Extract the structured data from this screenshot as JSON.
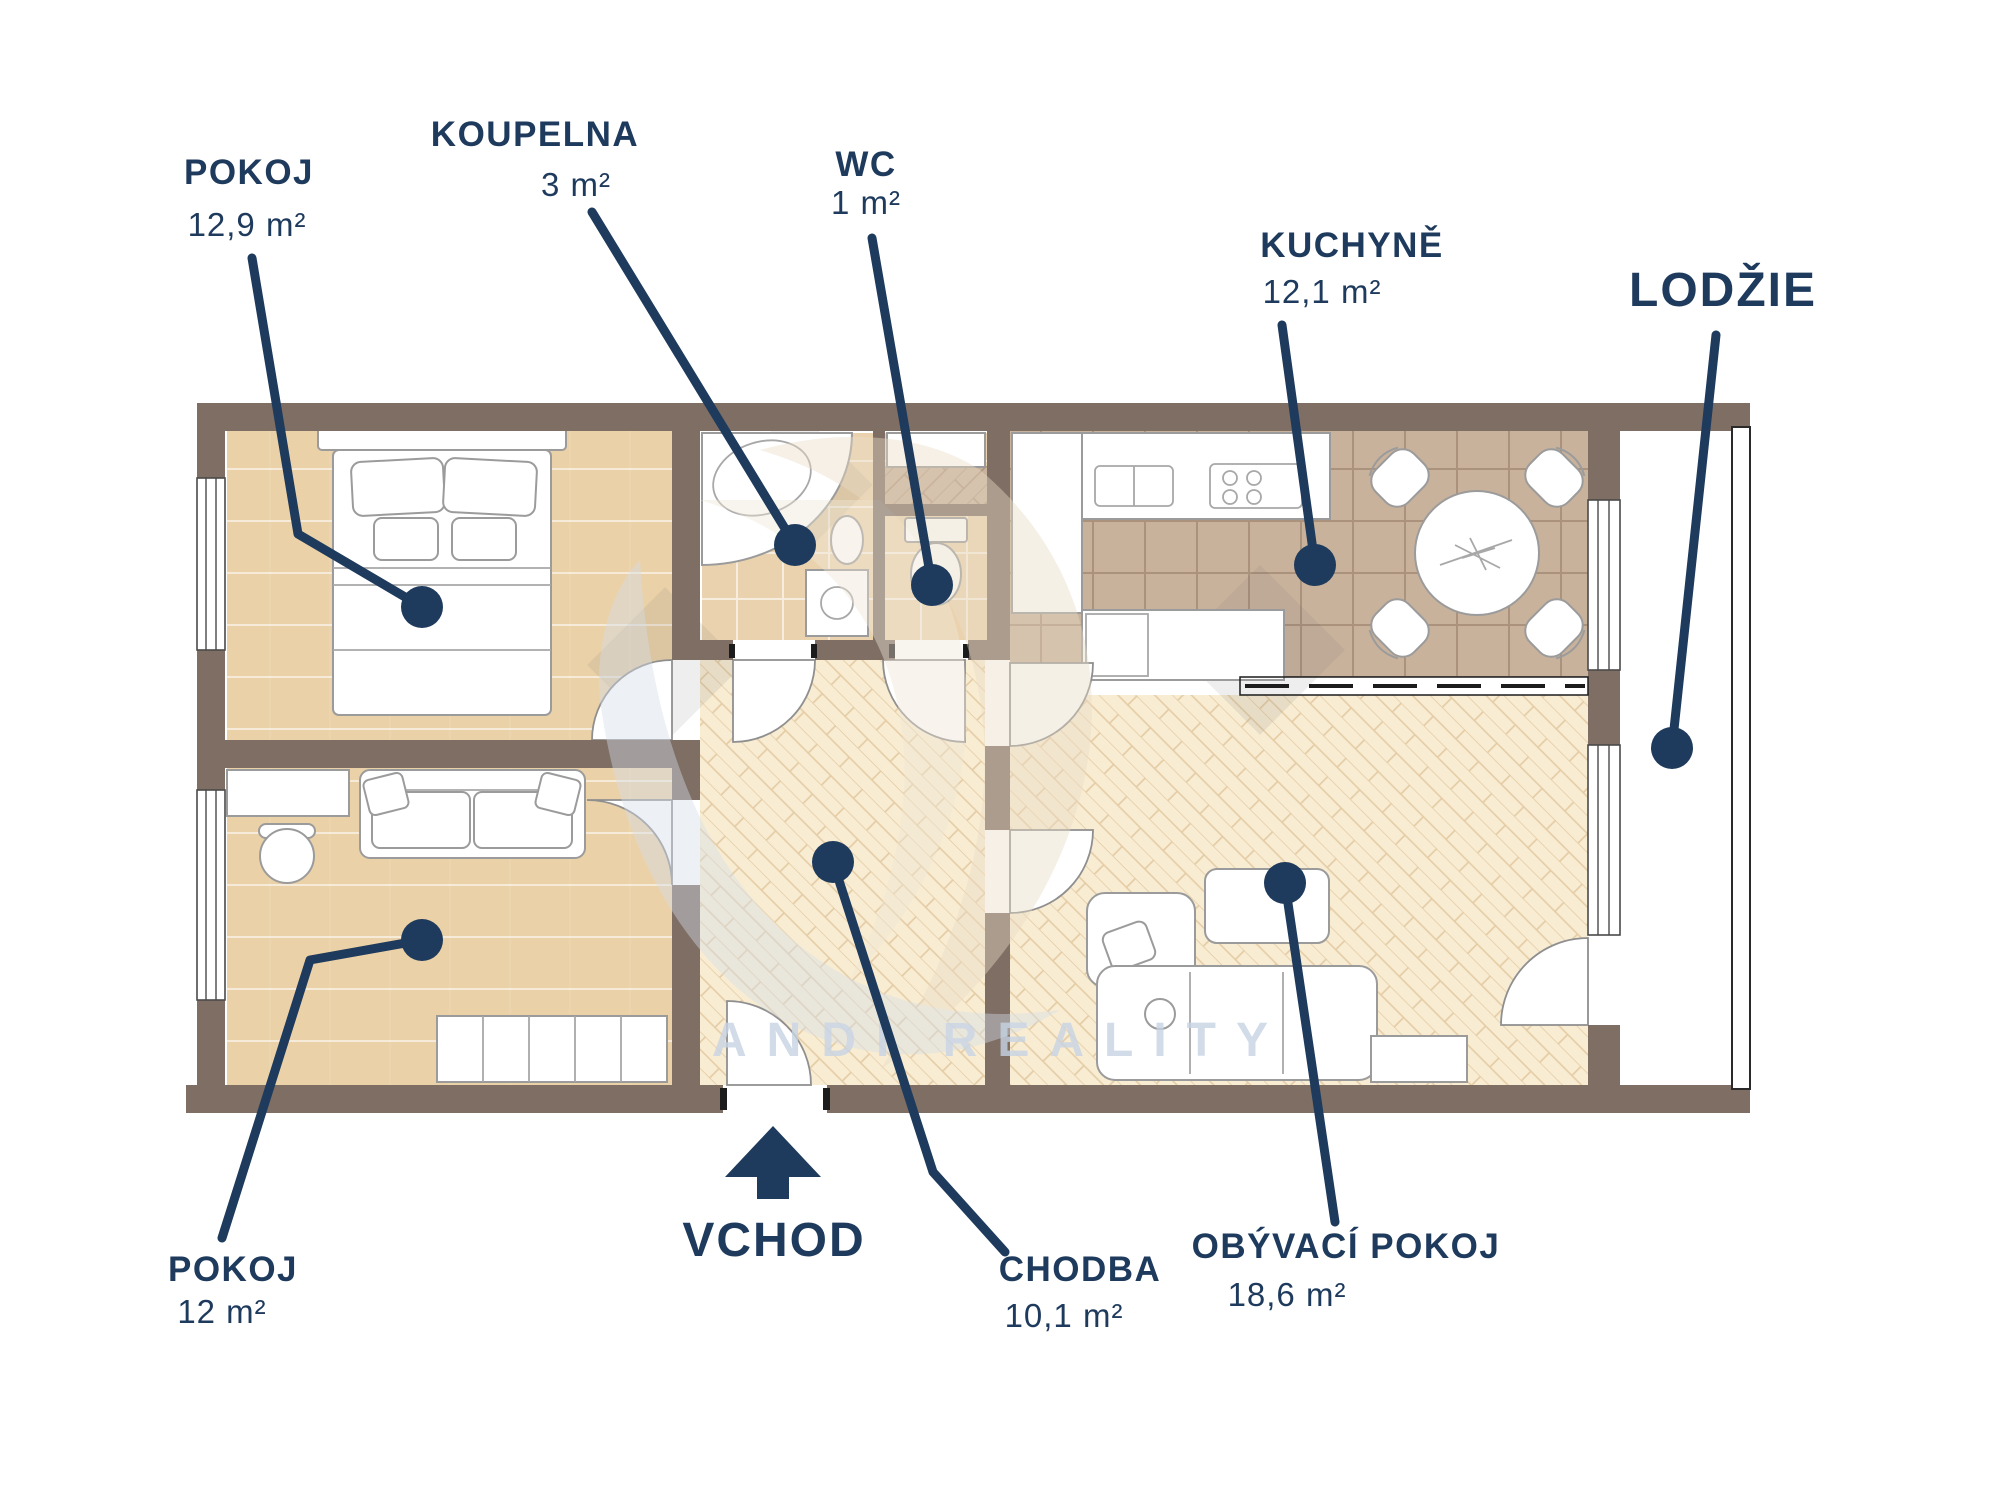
{
  "type": "apartment-floor-plan",
  "watermark": {
    "brand": "ANDI REALITY"
  },
  "entrance": {
    "label": "VCHOD"
  },
  "rooms": {
    "pokoj_top": {
      "label": "POKOJ",
      "area": "12,9 m²"
    },
    "koupelna": {
      "label": "KOUPELNA",
      "area": "3 m²"
    },
    "wc": {
      "label": "WC",
      "area": "1 m²"
    },
    "kuchyne": {
      "label": "KUCHYNĚ",
      "area": "12,1 m²"
    },
    "lodzie": {
      "label": "LODŽIE"
    },
    "pokoj_bottom": {
      "label": "POKOJ",
      "area": "12 m²"
    },
    "chodba": {
      "label": "CHODBA",
      "area": "10,1 m²"
    },
    "obyvaci": {
      "label": "OBÝVACÍ POKOJ",
      "area": "18,6 m²"
    }
  },
  "colors": {
    "label_navy": "#1E3A5C",
    "wall_brown": "#7E6E64",
    "wood_floor": "#EBD1A8",
    "tile_light": "#EAD2AE",
    "tile_dark": "#C9B29C",
    "herringbone_cream": "#F8ECD2",
    "watermark_blue": "#C7D4E4",
    "watermark_cream": "#E9DCC6"
  }
}
